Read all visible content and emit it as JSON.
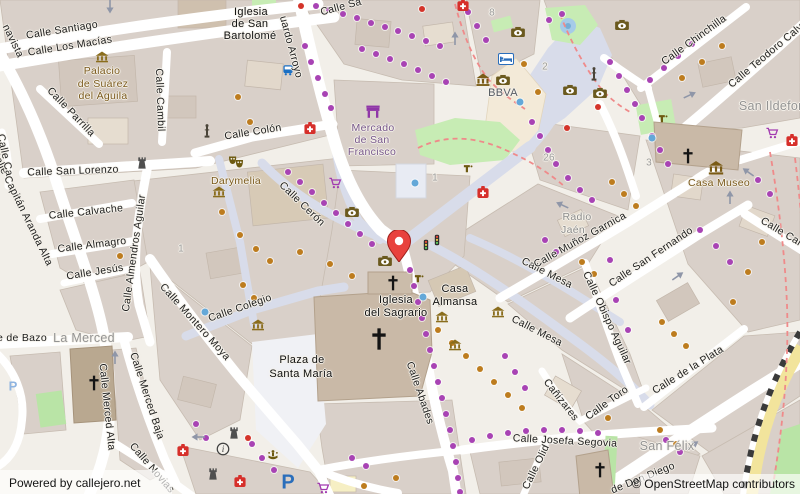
{
  "attribution": {
    "powered_by": "Powered by callejero.net",
    "osm": "© OpenStreetMap contributors"
  },
  "colors": {
    "background": "#f2efe9",
    "building": "#d9d0c9",
    "road": "#ffffff",
    "pedestrian": "#d8dcea",
    "green": "#c7ecb4",
    "plaza": "#f3ead8",
    "pin_red": "#e8423d",
    "poi_brown": "#7b5a1d",
    "dot_purple": "#a843b4",
    "dot_orange": "#bd7c1e",
    "water_blue": "#64a8d8"
  },
  "pin": {
    "x": 399,
    "y": 262
  },
  "labels": [
    {
      "t": "Calle Santiago",
      "x": 62,
      "y": 30,
      "r": -9,
      "c": "street"
    },
    {
      "t": "Calle Los Macías",
      "x": 70,
      "y": 46,
      "r": -9,
      "c": "street"
    },
    {
      "t": "navista",
      "x": 13,
      "y": 41,
      "r": 64,
      "c": "street"
    },
    {
      "t": "Calle Parrilla",
      "x": 71,
      "y": 112,
      "r": 46,
      "c": "street"
    },
    {
      "t": "Calle San Lorenzo",
      "x": 73,
      "y": 171,
      "r": -2,
      "c": "street"
    },
    {
      "t": "Calle Calvache",
      "x": 86,
      "y": 212,
      "r": -6,
      "c": "street"
    },
    {
      "t": "Calle Almagro",
      "x": 92,
      "y": 245,
      "r": -7,
      "c": "street"
    },
    {
      "t": "Calle Jesús",
      "x": 95,
      "y": 272,
      "r": -9,
      "c": "street"
    },
    {
      "t": "Calle Capitán Aranda Alta",
      "x": 22,
      "y": 208,
      "r": 64,
      "c": "street"
    },
    {
      "t": "Calle Cambil",
      "x": 160,
      "y": 100,
      "r": 88,
      "c": "street"
    },
    {
      "t": "Calle Colón",
      "x": 253,
      "y": 132,
      "r": -9,
      "c": "street"
    },
    {
      "t": "uardo Arroyo",
      "x": 291,
      "y": 47,
      "r": 75,
      "c": "street"
    },
    {
      "t": "Calle Sa",
      "x": 341,
      "y": 7,
      "r": -15,
      "c": "street"
    },
    {
      "t": "Calle Cerón",
      "x": 302,
      "y": 204,
      "r": 44,
      "c": "street"
    },
    {
      "t": "Calle Almendros Aguilar",
      "x": 134,
      "y": 253,
      "r": -82,
      "c": "street"
    },
    {
      "t": "Calle Montero Moya",
      "x": 195,
      "y": 322,
      "r": 48,
      "c": "street"
    },
    {
      "t": "Calle Colegio",
      "x": 240,
      "y": 308,
      "r": -19,
      "c": "street"
    },
    {
      "t": "Calle Merced Alta",
      "x": 107,
      "y": 407,
      "r": 84,
      "c": "street"
    },
    {
      "t": "Calle Merced Baja",
      "x": 147,
      "y": 396,
      "r": 72,
      "c": "street"
    },
    {
      "t": "Calle Novias",
      "x": 152,
      "y": 468,
      "r": 49,
      "c": "street"
    },
    {
      "t": "e de Bazo",
      "x": 22,
      "y": 338,
      "r": 0,
      "c": "street"
    },
    {
      "t": "Calle Abades",
      "x": 420,
      "y": 393,
      "r": 71,
      "c": "street"
    },
    {
      "t": "Calle Mesa",
      "x": 547,
      "y": 273,
      "r": 27,
      "c": "street"
    },
    {
      "t": "Calle Mesa",
      "x": 537,
      "y": 331,
      "r": 27,
      "c": "street"
    },
    {
      "t": "Calle Muñoz Garnica",
      "x": 580,
      "y": 240,
      "r": -29,
      "c": "street"
    },
    {
      "t": "Calle Obispo Aguilar",
      "x": 607,
      "y": 318,
      "r": 65,
      "c": "street"
    },
    {
      "t": "Calle San Fernando",
      "x": 651,
      "y": 257,
      "r": -34,
      "c": "street"
    },
    {
      "t": "Calle Carrera",
      "x": 790,
      "y": 237,
      "r": 31,
      "c": "street"
    },
    {
      "t": "Calle Chinchilla",
      "x": 694,
      "y": 40,
      "r": -36,
      "c": "street"
    },
    {
      "t": "Calle Teodoro Calvache",
      "x": 775,
      "y": 48,
      "r": -40,
      "c": "street"
    },
    {
      "t": "Cañizares",
      "x": 561,
      "y": 400,
      "r": 52,
      "c": "street"
    },
    {
      "t": "Calle Toro",
      "x": 607,
      "y": 403,
      "r": -36,
      "c": "street"
    },
    {
      "t": "Calle de la Plata",
      "x": 688,
      "y": 370,
      "r": -32,
      "c": "street"
    },
    {
      "t": "Calle Josefa Segovia",
      "x": 565,
      "y": 441,
      "r": 3,
      "c": "street"
    },
    {
      "t": "Calle Olid",
      "x": 536,
      "y": 467,
      "r": -64,
      "c": "street"
    },
    {
      "t": "de Don Diego",
      "x": 643,
      "y": 478,
      "r": -22,
      "c": "street"
    },
    {
      "t": "Calle Ca",
      "x": 5,
      "y": 155,
      "r": 78,
      "c": "street"
    },
    {
      "t": "Plaza de",
      "x": 302,
      "y": 360,
      "r": 0,
      "c": "name"
    },
    {
      "t": "Santa María",
      "x": 301,
      "y": 374,
      "r": 0,
      "c": "name"
    },
    {
      "t": "Iglesia",
      "x": 396,
      "y": 300,
      "r": 0,
      "c": "name"
    },
    {
      "t": "del Sagrario",
      "x": 396,
      "y": 313,
      "r": 0,
      "c": "name"
    },
    {
      "t": "Casa",
      "x": 455,
      "y": 289,
      "r": 0,
      "c": "name"
    },
    {
      "t": "Almansa",
      "x": 455,
      "y": 302,
      "r": 0,
      "c": "name"
    },
    {
      "t": "Iglesia",
      "x": 251,
      "y": 12,
      "r": 0,
      "c": "name"
    },
    {
      "t": "de San",
      "x": 250,
      "y": 24,
      "r": 0,
      "c": "name"
    },
    {
      "t": "Bartolomé",
      "x": 250,
      "y": 36,
      "r": 0,
      "c": "name"
    },
    {
      "t": "Radio",
      "x": 577,
      "y": 217,
      "r": 0,
      "c": "place"
    },
    {
      "t": "Jaén",
      "x": 573,
      "y": 230,
      "r": 0,
      "c": "place"
    },
    {
      "t": "La Merced",
      "x": 84,
      "y": 338,
      "r": 0,
      "c": "place-lg"
    },
    {
      "t": "San Félix",
      "x": 667,
      "y": 446,
      "r": 0,
      "c": "place-lg"
    },
    {
      "t": "San Ildefonso",
      "x": 779,
      "y": 106,
      "r": 0,
      "c": "place-lg"
    },
    {
      "t": "Palacio",
      "x": 102,
      "y": 71,
      "r": 0,
      "c": "poi"
    },
    {
      "t": "de Suárez",
      "x": 103,
      "y": 84,
      "r": 0,
      "c": "poi"
    },
    {
      "t": "del Águila",
      "x": 103,
      "y": 96,
      "r": 0,
      "c": "poi"
    },
    {
      "t": "Darymelia",
      "x": 236,
      "y": 181,
      "r": 0,
      "c": "poi"
    },
    {
      "t": "Casa Museo",
      "x": 719,
      "y": 183,
      "r": 0,
      "c": "poi"
    },
    {
      "t": "Mercado",
      "x": 373,
      "y": 128,
      "r": 0,
      "c": "poi-purple"
    },
    {
      "t": "de San",
      "x": 372,
      "y": 140,
      "r": 0,
      "c": "poi-purple"
    },
    {
      "t": "Francisco",
      "x": 372,
      "y": 152,
      "r": 0,
      "c": "poi-purple"
    },
    {
      "t": "BBVA",
      "x": 503,
      "y": 93,
      "r": 0,
      "c": "bank"
    },
    {
      "t": "8",
      "x": 492,
      "y": 13,
      "r": 0,
      "c": "num"
    },
    {
      "t": "2",
      "x": 545,
      "y": 67,
      "r": 0,
      "c": "num"
    },
    {
      "t": "26",
      "x": 549,
      "y": 158,
      "r": 0,
      "c": "num"
    },
    {
      "t": "1",
      "x": 435,
      "y": 178,
      "r": 0,
      "c": "num"
    },
    {
      "t": "1",
      "x": 181,
      "y": 249,
      "r": 0,
      "c": "num"
    },
    {
      "t": "3",
      "x": 649,
      "y": 163,
      "r": 0,
      "c": "num"
    }
  ],
  "icons": [
    [
      "pharmacy",
      463,
      5
    ],
    [
      "pharmacy",
      310,
      128
    ],
    [
      "pharmacy",
      483,
      192
    ],
    [
      "pharmacy",
      183,
      450
    ],
    [
      "pharmacy",
      240,
      481
    ],
    [
      "pharmacy",
      792,
      140
    ],
    [
      "camera",
      518,
      32
    ],
    [
      "camera",
      622,
      25
    ],
    [
      "camera",
      503,
      80
    ],
    [
      "camera",
      570,
      90
    ],
    [
      "camera",
      600,
      93
    ],
    [
      "camera",
      352,
      212
    ],
    [
      "camera",
      385,
      261
    ],
    [
      "bank",
      483,
      80
    ],
    [
      "museum",
      716,
      168
    ],
    [
      "masks",
      236,
      162
    ],
    [
      "heritage",
      102,
      57
    ],
    [
      "heritage",
      219,
      192
    ],
    [
      "heritage",
      258,
      325
    ],
    [
      "heritage",
      442,
      317
    ],
    [
      "heritage",
      498,
      312
    ],
    [
      "heritage",
      455,
      345
    ],
    [
      "cross",
      393,
      283
    ],
    [
      "cross-lg",
      379,
      339
    ],
    [
      "cross",
      94,
      383
    ],
    [
      "cross",
      688,
      156
    ],
    [
      "cross",
      600,
      470
    ],
    [
      "castle",
      142,
      163
    ],
    [
      "castle",
      234,
      433
    ],
    [
      "castle",
      213,
      474
    ],
    [
      "info",
      223,
      449
    ],
    [
      "fountain",
      273,
      456
    ],
    [
      "tap",
      419,
      278
    ],
    [
      "tap",
      663,
      118
    ],
    [
      "tap",
      468,
      168
    ],
    [
      "column",
      207,
      131
    ],
    [
      "column",
      594,
      74
    ],
    [
      "market",
      373,
      112
    ],
    [
      "hotel",
      506,
      59
    ],
    [
      "bus",
      288,
      70
    ],
    [
      "traffic",
      426,
      245
    ],
    [
      "traffic",
      437,
      240
    ],
    [
      "cart",
      335,
      183
    ],
    [
      "cart",
      323,
      488
    ],
    [
      "cart",
      772,
      133
    ]
  ],
  "parking": [
    {
      "t": "P",
      "x": 288,
      "y": 483,
      "size": 20,
      "strong": true
    },
    {
      "t": "P",
      "x": 13,
      "y": 386,
      "size": 13,
      "strong": false
    }
  ],
  "dots": {
    "purple": [
      [
        316,
        6
      ],
      [
        329,
        10
      ],
      [
        343,
        14
      ],
      [
        357,
        18
      ],
      [
        371,
        23
      ],
      [
        385,
        27
      ],
      [
        398,
        31
      ],
      [
        412,
        36
      ],
      [
        426,
        41
      ],
      [
        440,
        46
      ],
      [
        305,
        46
      ],
      [
        311,
        62
      ],
      [
        318,
        78
      ],
      [
        325,
        94
      ],
      [
        331,
        108
      ],
      [
        362,
        49
      ],
      [
        376,
        54
      ],
      [
        390,
        59
      ],
      [
        404,
        64
      ],
      [
        418,
        70
      ],
      [
        432,
        76
      ],
      [
        446,
        82
      ],
      [
        468,
        12
      ],
      [
        477,
        26
      ],
      [
        486,
        40
      ],
      [
        549,
        20
      ],
      [
        562,
        14
      ],
      [
        610,
        62
      ],
      [
        619,
        76
      ],
      [
        627,
        90
      ],
      [
        635,
        104
      ],
      [
        642,
        118
      ],
      [
        652,
        136
      ],
      [
        660,
        150
      ],
      [
        668,
        164
      ],
      [
        532,
        122
      ],
      [
        540,
        136
      ],
      [
        548,
        150
      ],
      [
        556,
        164
      ],
      [
        568,
        178
      ],
      [
        580,
        190
      ],
      [
        592,
        200
      ],
      [
        288,
        172
      ],
      [
        300,
        182
      ],
      [
        312,
        192
      ],
      [
        324,
        203
      ],
      [
        336,
        213
      ],
      [
        348,
        224
      ],
      [
        360,
        234
      ],
      [
        372,
        244
      ],
      [
        410,
        270
      ],
      [
        414,
        286
      ],
      [
        418,
        302
      ],
      [
        422,
        318
      ],
      [
        426,
        334
      ],
      [
        430,
        350
      ],
      [
        434,
        366
      ],
      [
        438,
        382
      ],
      [
        442,
        398
      ],
      [
        446,
        414
      ],
      [
        450,
        430
      ],
      [
        453,
        446
      ],
      [
        456,
        462
      ],
      [
        458,
        478
      ],
      [
        460,
        492
      ],
      [
        472,
        440
      ],
      [
        490,
        436
      ],
      [
        508,
        433
      ],
      [
        526,
        431
      ],
      [
        544,
        430
      ],
      [
        562,
        430
      ],
      [
        580,
        431
      ],
      [
        598,
        433
      ],
      [
        616,
        300
      ],
      [
        628,
        330
      ],
      [
        610,
        260
      ],
      [
        700,
        230
      ],
      [
        716,
        246
      ],
      [
        730,
        262
      ],
      [
        666,
        440
      ],
      [
        680,
        452
      ],
      [
        196,
        424
      ],
      [
        206,
        438
      ],
      [
        252,
        444
      ],
      [
        262,
        458
      ],
      [
        274,
        470
      ],
      [
        352,
        458
      ],
      [
        366,
        466
      ],
      [
        505,
        356
      ],
      [
        515,
        372
      ],
      [
        525,
        388
      ],
      [
        650,
        80
      ],
      [
        664,
        68
      ],
      [
        678,
        56
      ],
      [
        692,
        44
      ],
      [
        758,
        180
      ],
      [
        770,
        194
      ],
      [
        545,
        240
      ],
      [
        556,
        252
      ]
    ],
    "orange": [
      [
        238,
        97
      ],
      [
        250,
        122
      ],
      [
        222,
        212
      ],
      [
        240,
        235
      ],
      [
        256,
        249
      ],
      [
        270,
        261
      ],
      [
        300,
        252
      ],
      [
        330,
        264
      ],
      [
        352,
        276
      ],
      [
        243,
        285
      ],
      [
        254,
        298
      ],
      [
        438,
        330
      ],
      [
        452,
        343
      ],
      [
        466,
        356
      ],
      [
        480,
        369
      ],
      [
        494,
        382
      ],
      [
        508,
        395
      ],
      [
        522,
        408
      ],
      [
        612,
        182
      ],
      [
        624,
        194
      ],
      [
        636,
        206
      ],
      [
        582,
        262
      ],
      [
        594,
        274
      ],
      [
        662,
        322
      ],
      [
        674,
        334
      ],
      [
        686,
        346
      ],
      [
        733,
        302
      ],
      [
        748,
        272
      ],
      [
        762,
        242
      ],
      [
        682,
        78
      ],
      [
        702,
        62
      ],
      [
        722,
        46
      ],
      [
        660,
        430
      ],
      [
        676,
        444
      ],
      [
        608,
        418
      ],
      [
        364,
        486
      ],
      [
        396,
        478
      ],
      [
        120,
        256
      ],
      [
        128,
        300
      ],
      [
        538,
        92
      ],
      [
        524,
        64
      ]
    ],
    "red": [
      [
        422,
        9
      ],
      [
        598,
        107
      ],
      [
        567,
        128
      ],
      [
        248,
        438
      ],
      [
        301,
        6
      ]
    ],
    "blue": [
      [
        520,
        102
      ],
      [
        415,
        183
      ],
      [
        423,
        297
      ],
      [
        205,
        312
      ],
      [
        652,
        138
      ]
    ]
  },
  "arrows": [
    [
      455,
      38,
      -90
    ],
    [
      110,
      7,
      90
    ],
    [
      562,
      205,
      205
    ],
    [
      678,
      276,
      -35
    ],
    [
      730,
      197,
      -90
    ],
    [
      690,
      95,
      -25
    ],
    [
      598,
      410,
      -35
    ],
    [
      693,
      445,
      -35
    ],
    [
      115,
      357,
      -90
    ],
    [
      198,
      437,
      180
    ],
    [
      748,
      172,
      215
    ]
  ]
}
